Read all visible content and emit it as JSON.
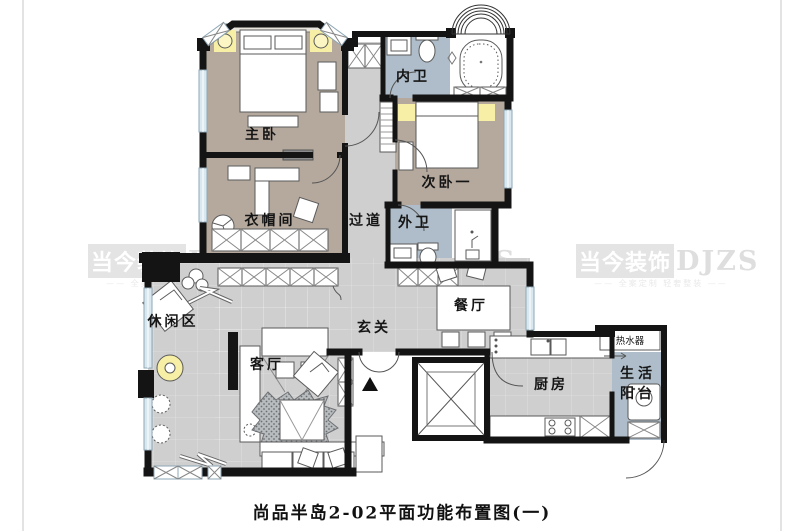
{
  "caption": "尚品半岛2-02平面功能布置图(一)",
  "watermark": {
    "brand_cn": "当今装饰",
    "brand_en": "DJZS",
    "tagline": "—— 全案定制 轻奢整装 ——"
  },
  "rooms": {
    "master_bedroom": "主卧",
    "cloakroom": "衣帽间",
    "corridor": "过道",
    "inner_bath": "内卫",
    "second_bedroom": "次卧一",
    "outer_bath": "外卫",
    "dining": "餐厅",
    "foyer": "玄关",
    "leisure": "休闲区",
    "living": "客厅",
    "kitchen": "厨房",
    "balcony_line1": "生活",
    "balcony_line2": "阳台",
    "water_heater": "热水器"
  },
  "colors": {
    "wall": "#141414",
    "floor-tan": "#b5a99e",
    "floor-gray": "#cfcfcf",
    "floor-blue": "#aebdc9",
    "window": "#d9e8f0",
    "accent-yellow": "#f6efa5",
    "wm": "#e4e4e4"
  }
}
